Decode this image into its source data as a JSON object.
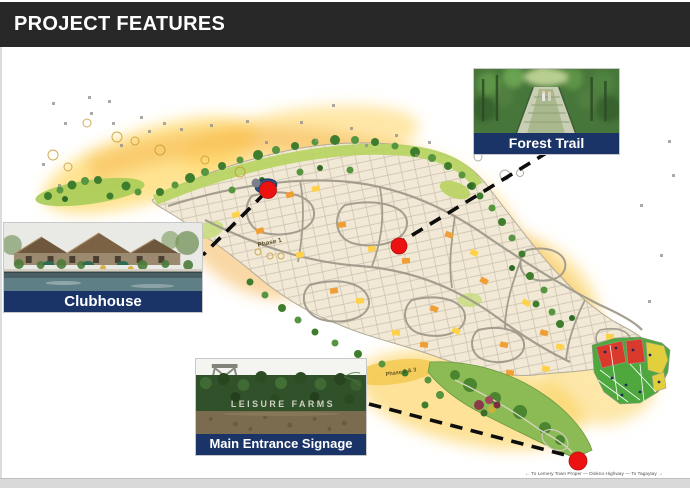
{
  "slide": {
    "title": "PROJECT FEATURES"
  },
  "callouts": {
    "forest_trail": {
      "label": "Forest Trail"
    },
    "clubhouse": {
      "label": "Clubhouse"
    },
    "main_entrance": {
      "label": "Main Entrance Signage"
    }
  },
  "map": {
    "phase1_label": "Phase 1",
    "phase23_label": "Phase 2 & 3",
    "entrance_sign_text": "LEISURE FARMS",
    "road_caption": "← To Lemery Town Proper — Diokno Highway — To Tagaytay →",
    "markers": [
      "clubhouse",
      "forest-trail",
      "main-entrance"
    ]
  },
  "colors": {
    "header_bg": "#282828",
    "label_bg": "#1b3468",
    "marker": "#ed1212",
    "glow": "#ffd24d",
    "lots": "#f1e9d6",
    "roads": "#a09a8c",
    "trees": "#3f7d2e"
  }
}
